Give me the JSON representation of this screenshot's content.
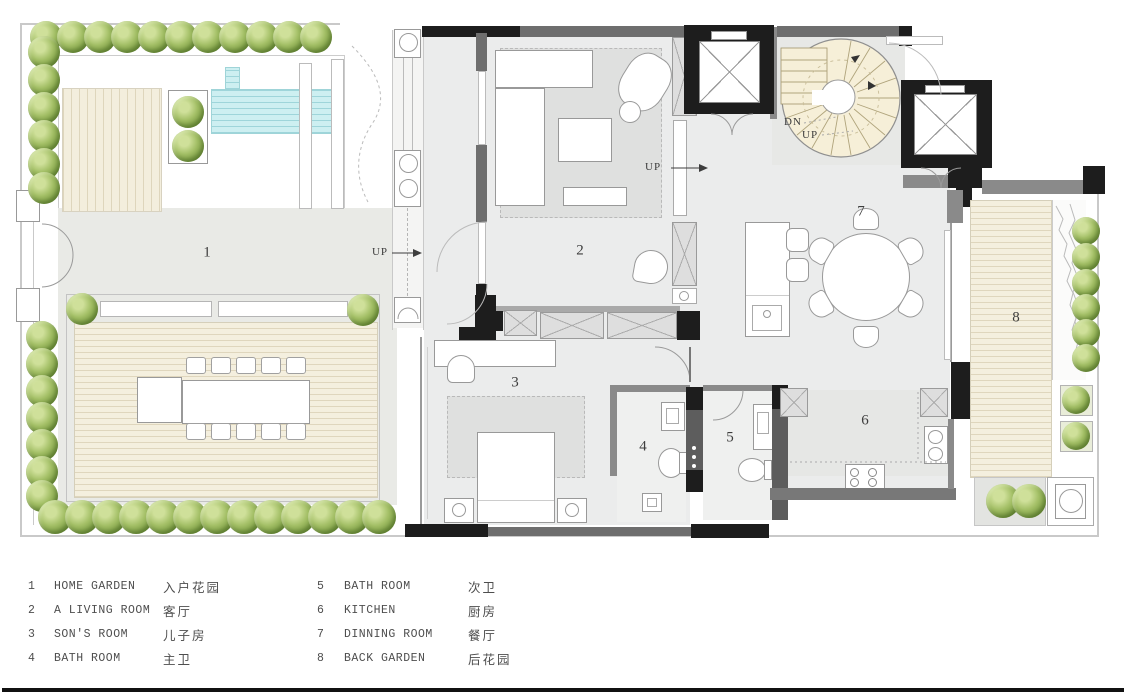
{
  "plan": {
    "rooms": [
      {
        "num": "1",
        "name": "HOME GARDEN"
      },
      {
        "num": "2",
        "name": "A LIVING ROOM"
      },
      {
        "num": "3",
        "name": "SON'S ROOM"
      },
      {
        "num": "4",
        "name": "BATH ROOM"
      },
      {
        "num": "5",
        "name": "BATH ROOM"
      },
      {
        "num": "6",
        "name": "KITCHEN"
      },
      {
        "num": "7",
        "name": "DINNING ROOM"
      },
      {
        "num": "8",
        "name": "BACK GARDEN"
      }
    ],
    "annotations": {
      "up_hall": "UP",
      "up_living": "UP",
      "stair_dn": "DN",
      "stair_up": "UP"
    }
  },
  "legend": {
    "items": [
      {
        "num": "1",
        "en": "HOME GARDEN",
        "zh": "入户花园"
      },
      {
        "num": "2",
        "en": "A LIVING ROOM",
        "zh": "客厅"
      },
      {
        "num": "3",
        "en": "SON'S ROOM",
        "zh": "儿子房"
      },
      {
        "num": "4",
        "en": "BATH ROOM",
        "zh": "主卫"
      },
      {
        "num": "5",
        "en": "BATH ROOM",
        "zh": "次卫"
      },
      {
        "num": "6",
        "en": "KITCHEN",
        "zh": "厨房"
      },
      {
        "num": "7",
        "en": "DINNING ROOM",
        "zh": "餐厅"
      },
      {
        "num": "8",
        "en": "BACK GARDEN",
        "zh": "后花园"
      }
    ]
  },
  "colors": {
    "wall_black": "#1d1d1d",
    "wall_gray": "#6e6e6e",
    "floor_gray": "#ebecec",
    "deck_wood": "#f4efde",
    "pool_water": "#cdeff1",
    "tree_green": "#7d9f44",
    "stair_cream": "#f6efd8"
  }
}
